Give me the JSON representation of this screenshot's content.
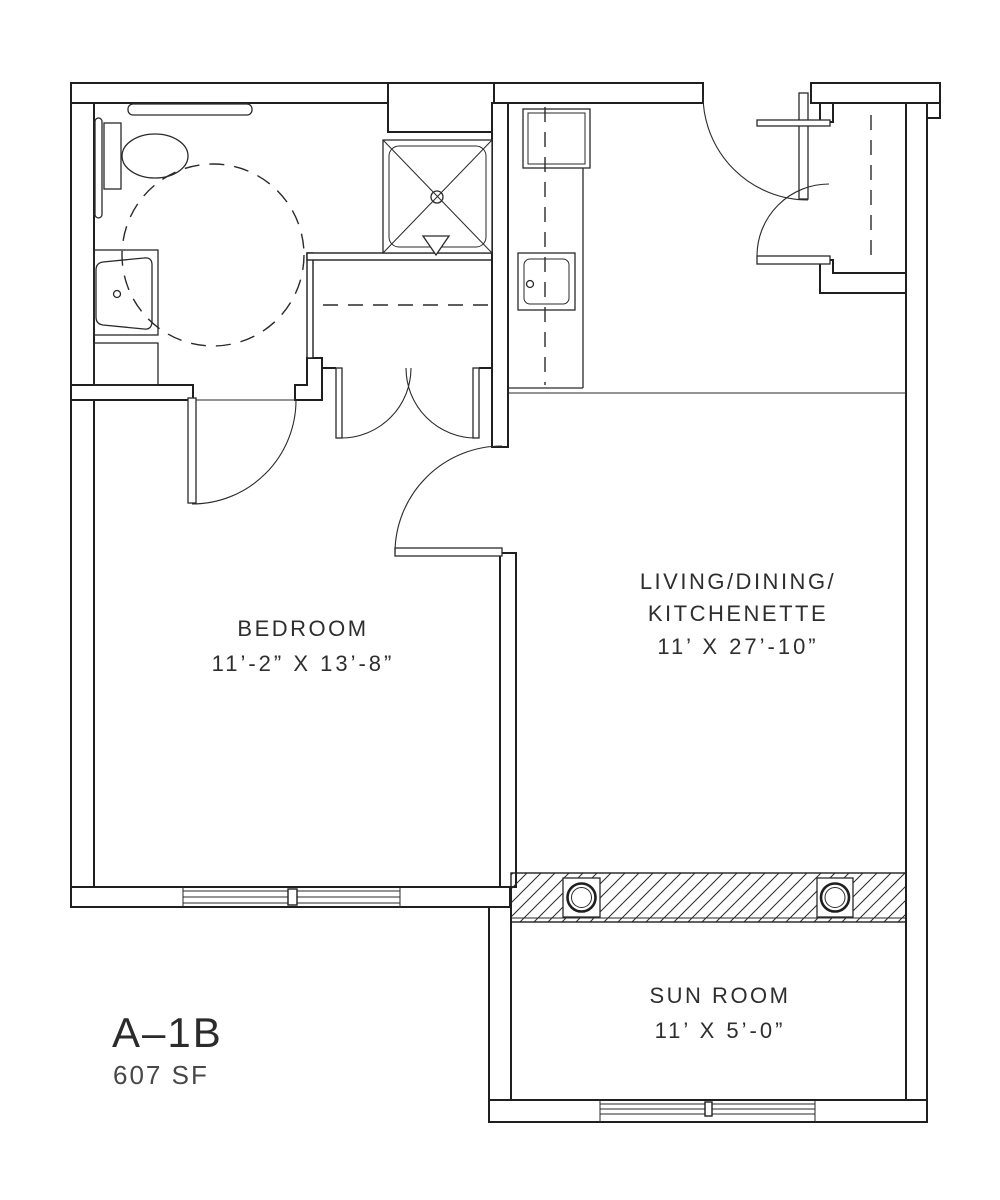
{
  "drawing": {
    "type": "apartment-unit-floor-plan",
    "unit": {
      "label": "A–1B",
      "area": "607 SF"
    },
    "rooms": {
      "bedroom": {
        "name": "BEDROOM",
        "dims": "11’-2” X 13’-8”"
      },
      "living": {
        "name_line1": "LIVING/DINING/",
        "name_line2": "KITCHENETTE",
        "dims": "11’ X 27’-10”"
      },
      "sunroom": {
        "name": "SUN ROOM",
        "dims": "11’ X 5’-0”"
      }
    },
    "fixtures": {
      "bathroom": [
        "grab-bar",
        "toilet",
        "vanity-sink",
        "base-cabinet",
        "accessible-turning-circle"
      ],
      "shower": [
        "roll-in-shower",
        "floor-drain",
        "shower-symbol-triangle"
      ],
      "kitchen": [
        "refrigerator",
        "counter",
        "kitchen-sink",
        "upper-cabinet-dashed-line"
      ],
      "entry": [
        "entry-door",
        "coat-closet",
        "closet-rod-dashed",
        "shelf"
      ],
      "hall": [
        "double-door-closet",
        "closet-shelf-dashed"
      ],
      "sunroom": [
        "structural-columns",
        "window-wall",
        "hatched-wall-band"
      ]
    },
    "colors": {
      "line": "#1f1f1f",
      "text": "#2e2e2e",
      "background": "#ffffff"
    }
  }
}
